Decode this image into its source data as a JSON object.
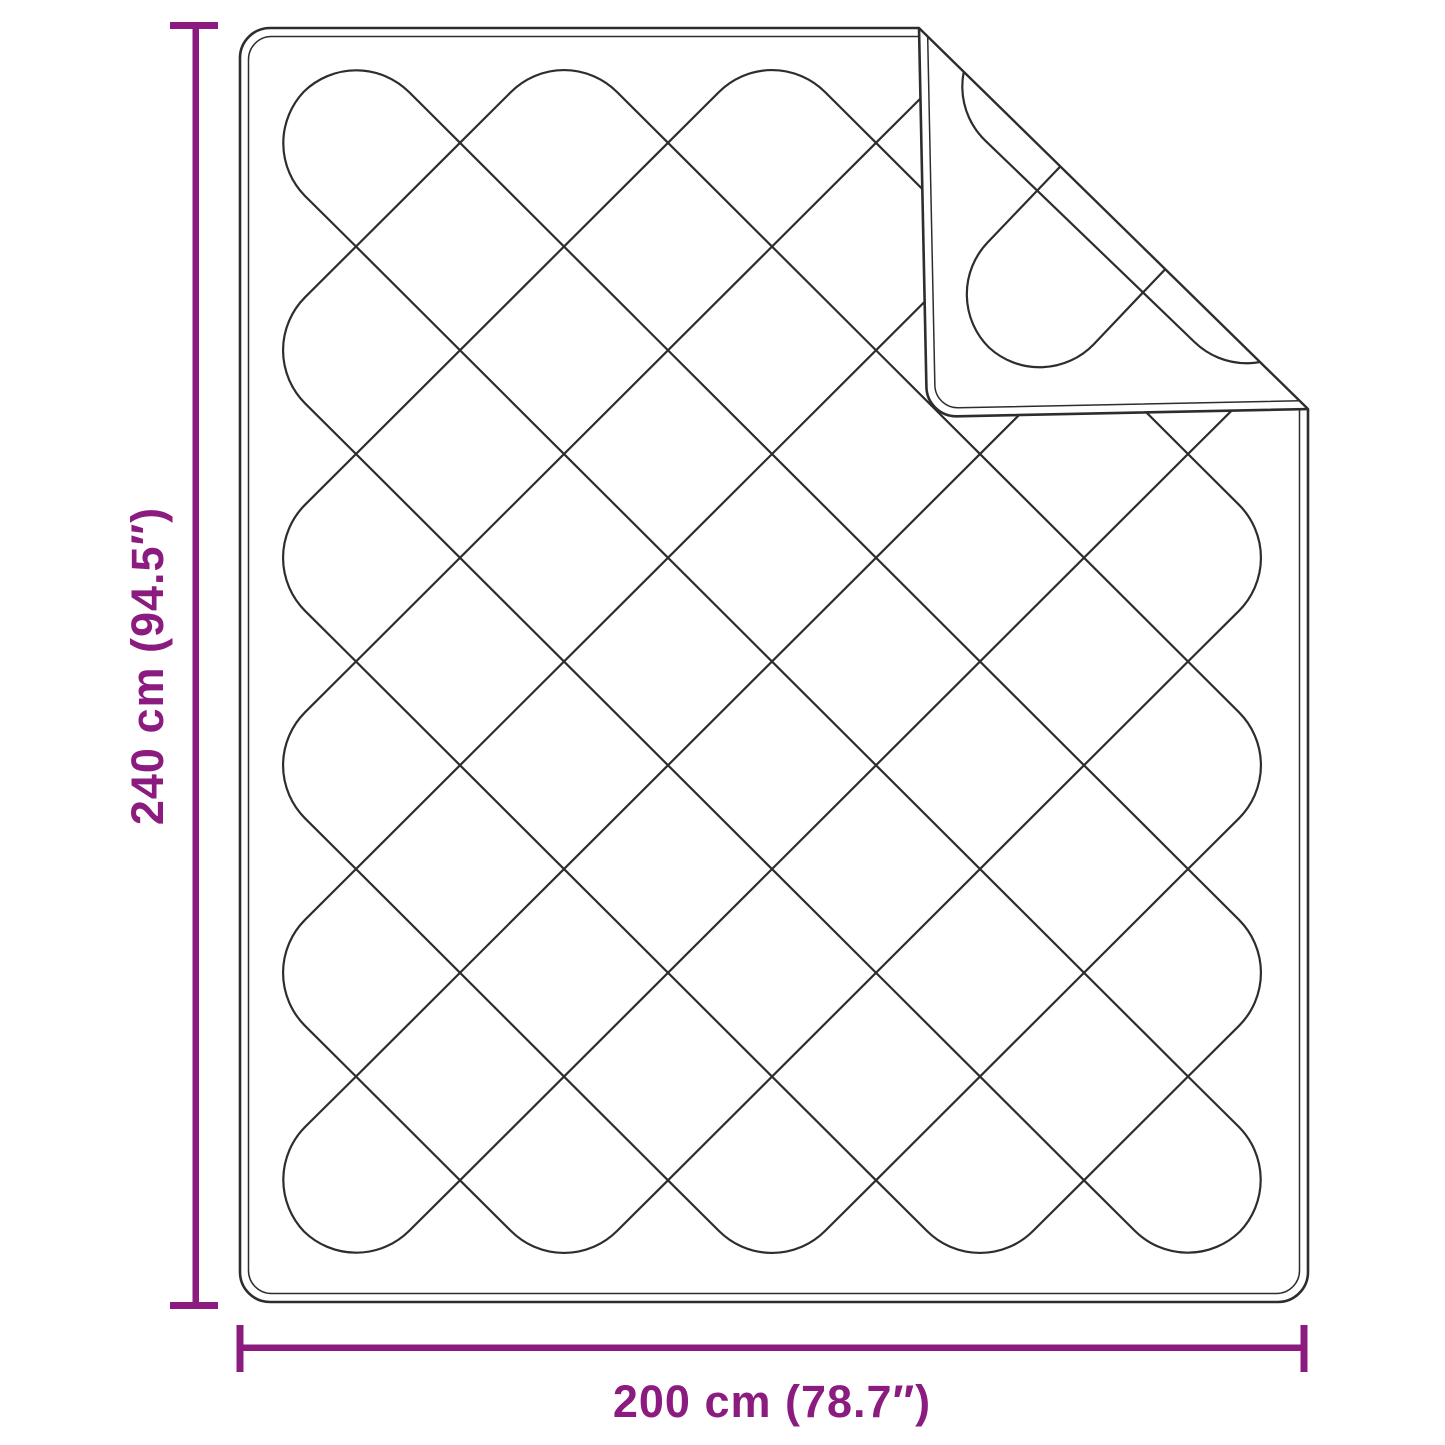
{
  "page": {
    "title": "Blanket dimension diagram"
  },
  "diagram": {
    "subject": "quilted-blanket-top-view-with-folded-corner",
    "height_dimension": {
      "label": "240 cm (94.5″)"
    },
    "width_dimension": {
      "label": "200 cm (78.7″)"
    }
  },
  "colors": {
    "accent": "#8C1B7F",
    "line": "#2D2D2D",
    "background": "#FFFFFF"
  }
}
